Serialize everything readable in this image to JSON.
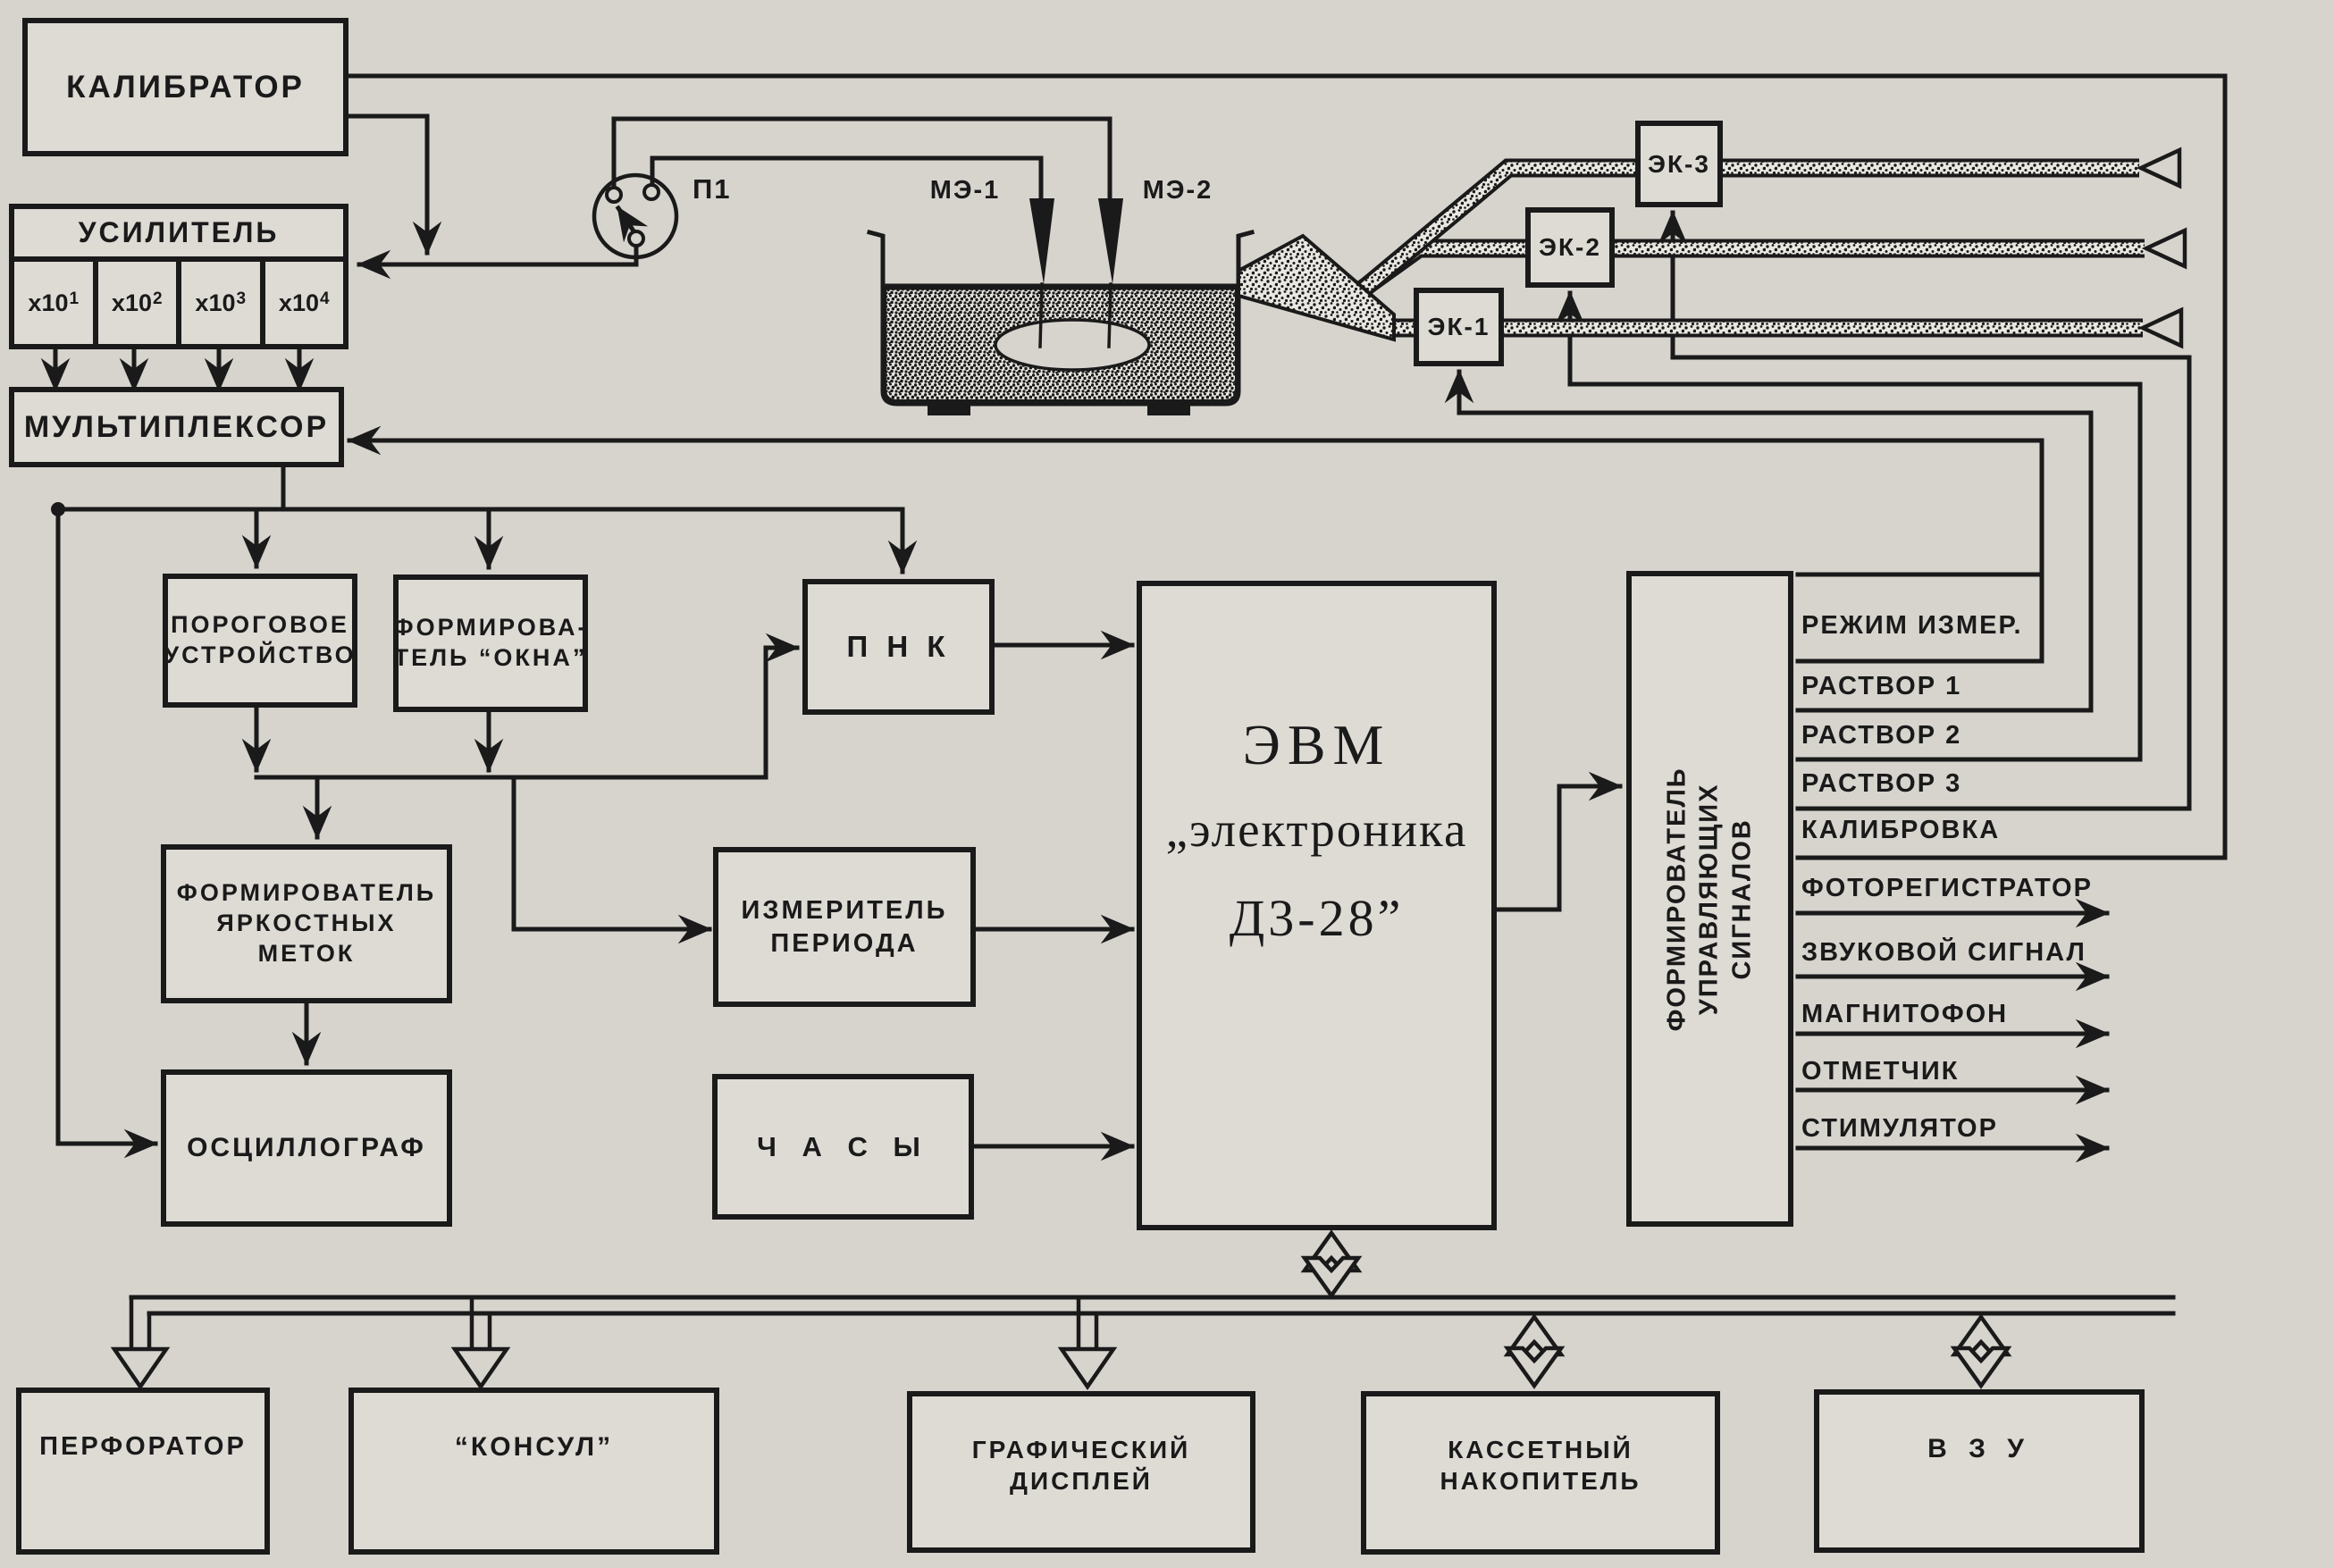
{
  "diagram": {
    "calibrator": "КАЛИБРАТОР",
    "amplifier": {
      "title": "УСИЛИТЕЛЬ",
      "gains": [
        {
          "b": "x10",
          "e": "1"
        },
        {
          "b": "x10",
          "e": "2"
        },
        {
          "b": "x10",
          "e": "3"
        },
        {
          "b": "x10",
          "e": "4"
        }
      ]
    },
    "multiplexer": "МУЛЬТИПЛЕКСОР",
    "switch_p1": "П1",
    "electrode1": "МЭ-1",
    "electrode2": "МЭ-2",
    "valves": [
      "ЭК-1",
      "ЭК-2",
      "ЭК-3"
    ],
    "threshold": [
      "ПОРОГОВОЕ",
      "УСТРОЙСТВО"
    ],
    "window_former": [
      "ФОРМИРОВА-",
      "ТЕЛЬ “ОКНА”"
    ],
    "pnk": "П Н К",
    "mark_former": [
      "ФОРМИРОВАТЕЛЬ",
      "ЯРКОСТНЫХ",
      "МЕТОК"
    ],
    "period_meter": [
      "ИЗМЕРИТЕЛЬ",
      "ПЕРИОДА"
    ],
    "oscilloscope": "ОСЦИЛЛОГРАФ",
    "clock": "Ч А С Ы",
    "computer": [
      "ЭВМ",
      "„электроника",
      "Д3-28”"
    ],
    "signal_former": [
      "ФОРМИРОВАТЕЛЬ УПРАВЛЯЮЩИХ",
      "СИГНАЛОВ"
    ],
    "ctrl_outputs": [
      "РЕЖИМ ИЗМЕР.",
      "РАСТВОР 1",
      "РАСТВОР 2",
      "РАСТВОР 3",
      "КАЛИБРОВКА"
    ],
    "ext_outputs": [
      "ФОТОРЕГИСТРАТОР",
      "ЗВУКОВОЙ СИГНАЛ",
      "МАГНИТОФОН",
      "ОТМЕТЧИК",
      "СТИМУЛЯТОР"
    ],
    "peripherals": [
      [
        "ПЕРФОРАТОР"
      ],
      [
        "“КОНСУЛ”"
      ],
      [
        "ГРАФИЧЕСКИЙ",
        "ДИСПЛЕЙ"
      ],
      [
        "КАССЕТНЫЙ",
        "НАКОПИТЕЛЬ"
      ],
      [
        "В З У"
      ]
    ]
  },
  "colors": {
    "paper": "#d7d4ce",
    "paper_light": "#dedbd5",
    "ink": "#1a1a1a",
    "tube_fill": "#e9e7e1"
  }
}
